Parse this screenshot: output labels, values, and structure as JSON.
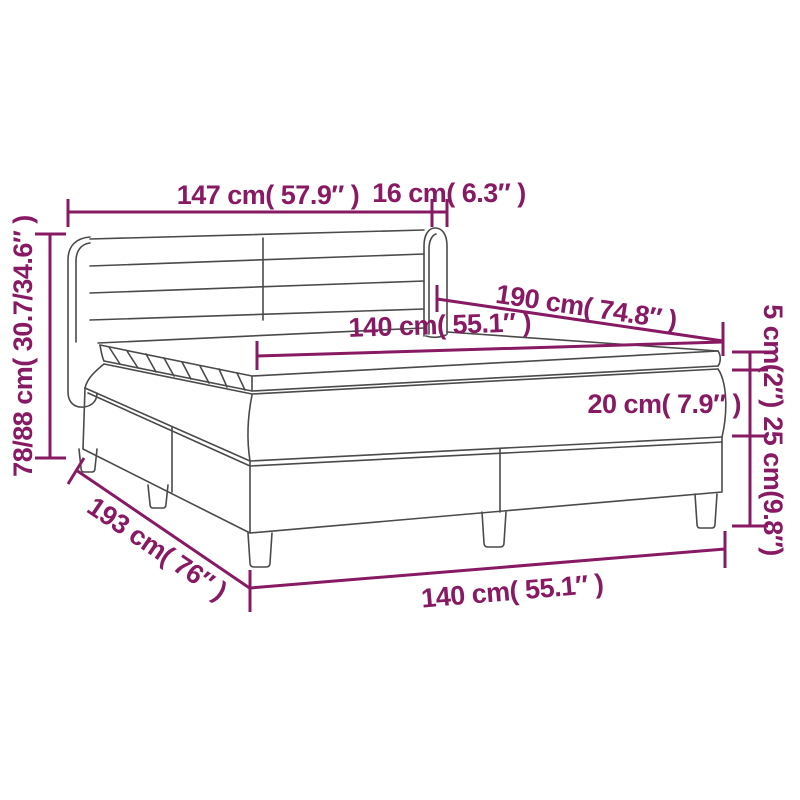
{
  "diagram": {
    "title_hint": "box-spring-bed-dimension-diagram",
    "labels": {
      "headboard_width": "147 cm( 57.9″ )",
      "headboard_wing_depth": "16 cm( 6.3″ )",
      "bed_height_range": "78/88 cm( 30.7/34.6″ )",
      "bed_length": "190 cm( 74.8″ )",
      "mattress_width": "140 cm( 55.1″ )",
      "topper_thickness": "5 cm(2″)",
      "mattress_thickness": "20 cm( 7.9″ )",
      "base_height": "25 cm(9.8″)",
      "bed_depth": "193 cm( 76″ )",
      "base_width": "140 cm( 55.1″ )"
    },
    "colors": {
      "dimension_annotations": "#871A63",
      "line_art": "#4A4A4A",
      "background": "#FFFFFF"
    }
  }
}
